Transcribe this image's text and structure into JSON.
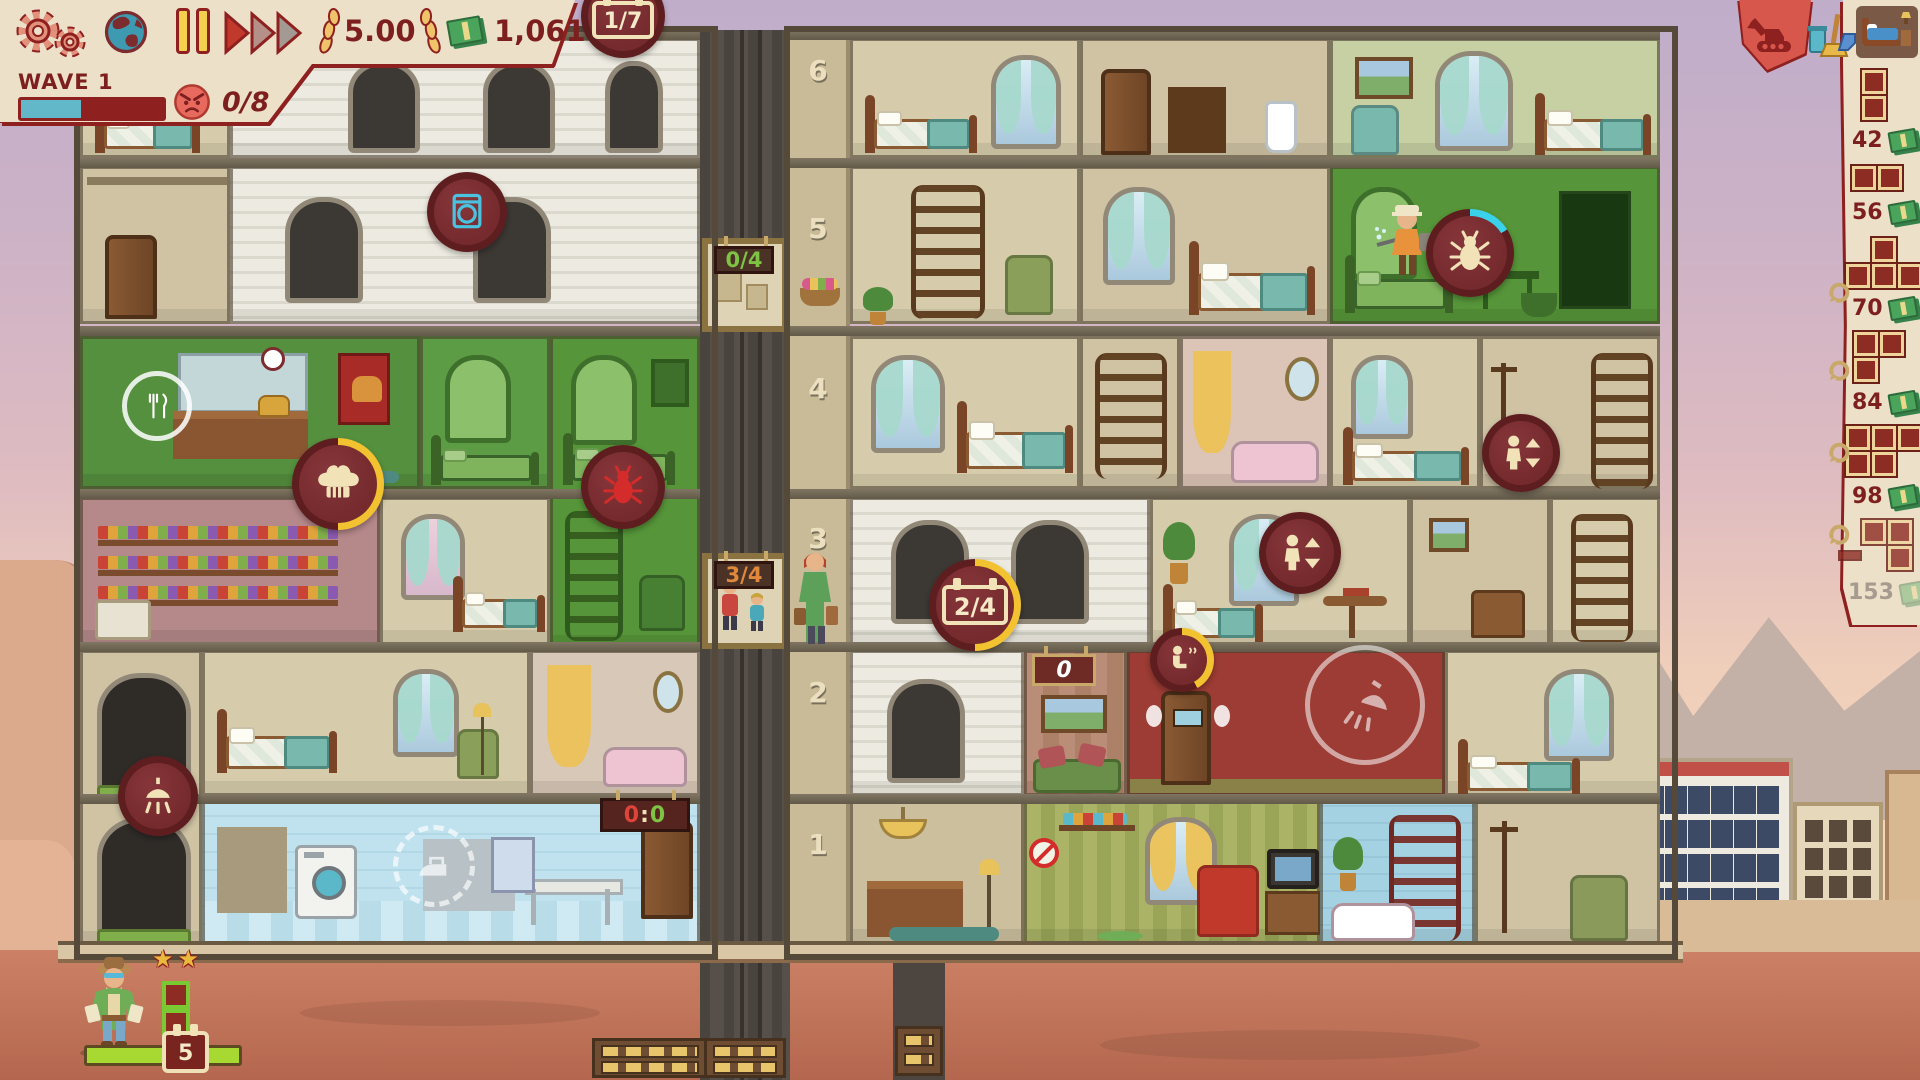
{
  "hud": {
    "wave_label": "WAVE 1",
    "wave_progress_pct": 42,
    "anger_count": "0/8",
    "rating": "5.00",
    "money": "1,061",
    "day_counter": "1/7",
    "day_ring_pct": 0
  },
  "toolbar": {
    "demolish_icon": "excavator",
    "cleaning_icon": "trash-broom-dustpan",
    "rooms_icon": "bed-furniture"
  },
  "shop": {
    "items": [
      {
        "shape": "2-cells-vertical",
        "price": "42",
        "enabled": true
      },
      {
        "shape": "2-cells-horizontal",
        "price": "56",
        "enabled": true
      },
      {
        "shape": "4-cells-T",
        "price": "70",
        "enabled": true
      },
      {
        "shape": "3-cells-corner",
        "price": "84",
        "enabled": true
      },
      {
        "shape": "5-cells-P",
        "price": "98",
        "enabled": true
      },
      {
        "shape": "3-cells-S",
        "price": "153",
        "enabled": false
      }
    ]
  },
  "building": {
    "floor_labels": [
      "6",
      "5",
      "4",
      "3",
      "2",
      "1"
    ],
    "elevator": {
      "upper_car_occupancy": "0/4",
      "lower_car_occupancy": "3/4"
    },
    "laundry_scoreboard": {
      "left": "0",
      "sep": ":",
      "right": "0"
    },
    "lounge_counter": "0",
    "room_timer": "2/4",
    "room_timer_ring_pct": 50,
    "chef_ring_pct": 50,
    "pest_ring_pct": 16,
    "toilet_ring_pct": 42
  },
  "guest_panel": {
    "stars": "★★",
    "patience_pct": 100,
    "days_badge": "5"
  }
}
